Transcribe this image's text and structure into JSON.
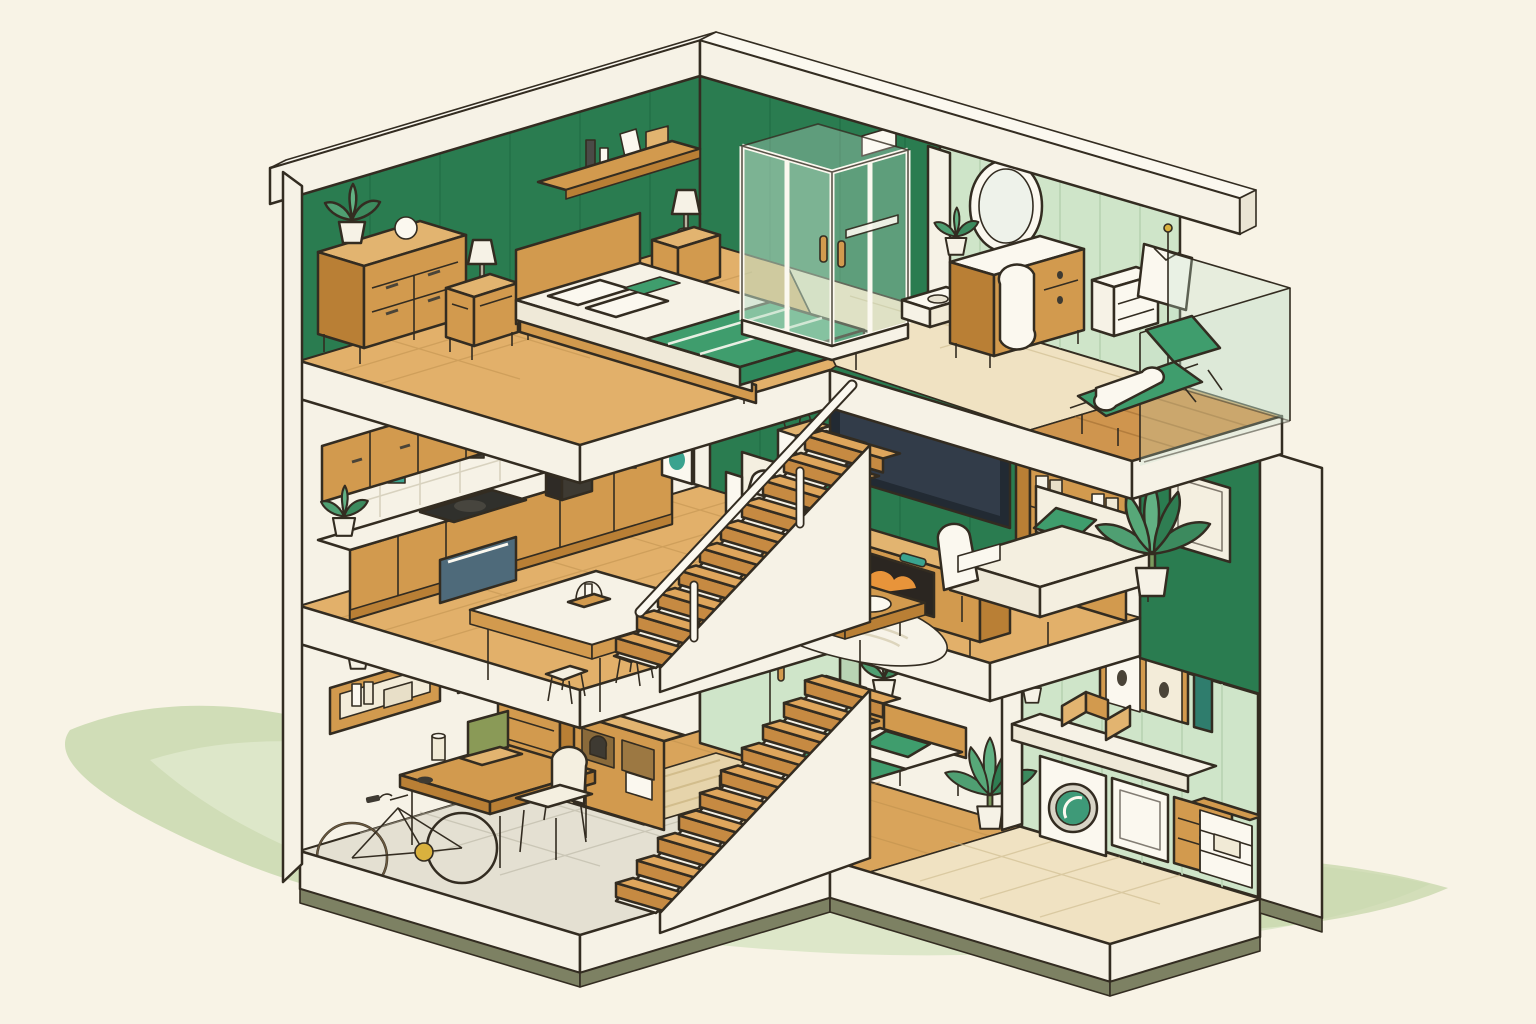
{
  "scene": {
    "title": "Isometric cutaway illustration of a three-story house interior with green walls and wooden furniture",
    "style": "flat cartoon line art, cream background, sage-green ground wash",
    "floors": [
      {
        "name": "Top floor",
        "rooms": [
          {
            "name": "Master bedroom",
            "items": [
              "double-bed",
              "wood-headboard",
              "white-pillows",
              "green-blanket-band",
              "wall-shelf-with-bottles-and-box",
              "nightstand-with-lamp",
              "second-nightstand-with-lamp",
              "four-drawer-dresser",
              "potted-plant",
              "decor-sphere",
              "dark-green-panel-wall",
              "tan-tile-floor"
            ]
          },
          {
            "name": "Bathroom",
            "items": [
              "glass-walk-in-shower",
              "wood-shower-handles",
              "wall-hung-sink",
              "white-wall-box",
              "dark-green-wall",
              "pale-tile-floor"
            ]
          },
          {
            "name": "Vanity corner",
            "items": [
              "round-mirror-on-stand",
              "vanity-dresser",
              "white-laundry-basket",
              "small-potted-plant",
              "clothes-rack-with-white-garment",
              "white-drawer-unit",
              "white-stool",
              "light-green-panel-wall"
            ]
          },
          {
            "name": "Balcony",
            "items": [
              "wood-lounge-chair",
              "green-cushions",
              "white-blanket",
              "glass-railing-with-wood-frame",
              "wood-plank-deck"
            ]
          }
        ]
      },
      {
        "name": "Middle floor",
        "rooms": [
          {
            "name": "Kitchen",
            "items": [
              "upper-wood-cabinets",
              "tile-backsplash",
              "teal-accent-tiles",
              "black-cooktop",
              "wall-oven",
              "coffee-maker",
              "canisters",
              "white-appliance",
              "counter-with-wood-cabinets",
              "potted-plant"
            ]
          },
          {
            "name": "Dining area",
            "items": [
              "white-top-dining-table",
              "candle-lantern-centerpiece",
              "four-stools"
            ]
          },
          {
            "name": "Living room",
            "items": [
              "wall-mounted-tv",
              "tv-console-with-fireplace",
              "small-wood-cabinet",
              "floating-shelves",
              "framed-art",
              "flower-planter",
              "bookshelf-with-white-books",
              "cream-sofa-with-green-pillow",
              "tall-potted-plant",
              "coffee-table-with-tray",
              "white-area-rug",
              "white-armchair",
              "dark-green-accent-wall"
            ]
          },
          {
            "name": "Upper staircase",
            "items": [
              "wood-treads",
              "white-stringer",
              "white-railing"
            ]
          }
        ]
      },
      {
        "name": "Ground floor",
        "rooms": [
          {
            "name": "Home office / garage",
            "items": [
              "bicycle",
              "wood-desk",
              "laptop",
              "drinking-glass",
              "white-desk-chair",
              "wall-shelf-with-books",
              "cube-shelf",
              "potted-plant",
              "gray-tile-floor",
              "wall-outlet"
            ]
          },
          {
            "name": "Hallway",
            "items": [
              "small-dresser-with-teal-books",
              "storage-cubby-with-boxes",
              "woven-rug",
              "lower-staircase"
            ]
          },
          {
            "name": "Small bedroom",
            "items": [
              "light-green-wardrobe",
              "wood-handles",
              "nightstand-with-plant",
              "single-bed-green-and-white-bedding",
              "green-pillow",
              "tan-rug",
              "tall-potted-plant"
            ]
          },
          {
            "name": "Laundry room",
            "items": [
              "washing-machine-green-door",
              "white-counter",
              "white-cabinet",
              "wood-drawer-unit",
              "open-shelf-unit",
              "wall-cabinet",
              "teal-book",
              "wood-book-stands",
              "small-plant",
              "light-green-wall",
              "olive-baseboard"
            ]
          }
        ]
      }
    ]
  },
  "palette": {
    "background": "#f8f3e6",
    "ground_wash": "#c9d8ae",
    "ground_wash_light": "#dde7c9",
    "outline": "#332c21",
    "white_wall": "#f6f2e6",
    "white_shade": "#eae4d3",
    "green_dark": "#2a7c50",
    "green_mid": "#4f9f72",
    "green_light_panel": "#cfe5c9",
    "green_panel_line": "#b9d4b4",
    "glass_green": "#bfe0cb",
    "wood": "#d29a4e",
    "wood_dark": "#b97f35",
    "wood_light": "#e2b470",
    "floor_tan": "#e2b06a",
    "floor_pale": "#f0e2c2",
    "floor_gray": "#e4e0d2",
    "textile_green": "#3f9d6d",
    "cream": "#f4efe0",
    "tv_screen": "#323c49",
    "teal_accent": "#3aa38f",
    "olive_base": "#7d8163"
  }
}
